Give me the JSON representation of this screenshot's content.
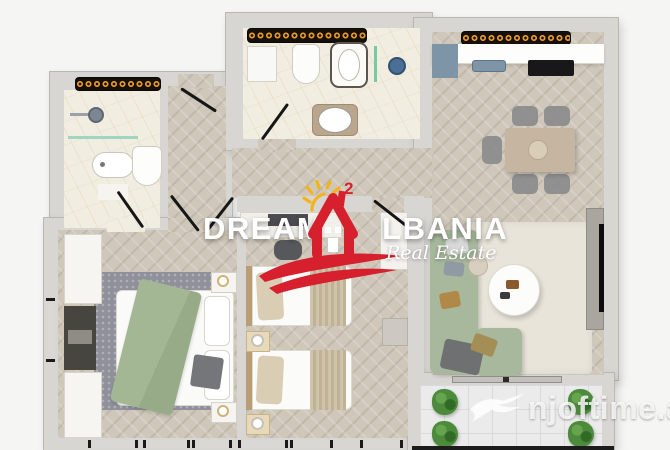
{
  "watermark": {
    "brand_left": "DREAM",
    "brand_right": "LBANIA",
    "tagline": "Real Estate",
    "smoke_glyph": "2"
  },
  "corner_watermark": {
    "site": "njoftime.al"
  },
  "colors": {
    "brand_red": "#d6202e",
    "brand_yellow": "#f3b31c",
    "watermark_white": "#ffffff",
    "background": "#f5f5f4",
    "wall": "#d8d6d2",
    "wood_floor": "#cfc7b9",
    "marble_floor": "#f2ede1",
    "balcony_tile": "#eaebea",
    "sofa_green": "#a7b89c",
    "blanket_green": "#a4b795",
    "plant_green": "#4c8a3c",
    "radiator_coil_orange": "#e89a25"
  },
  "icons": [
    {
      "name": "house-logo-icon"
    },
    {
      "name": "sun-rays-icon"
    },
    {
      "name": "chimney-smoke-2-icon"
    },
    {
      "name": "wave-swoosh-icon"
    },
    {
      "name": "bird-icon"
    }
  ]
}
